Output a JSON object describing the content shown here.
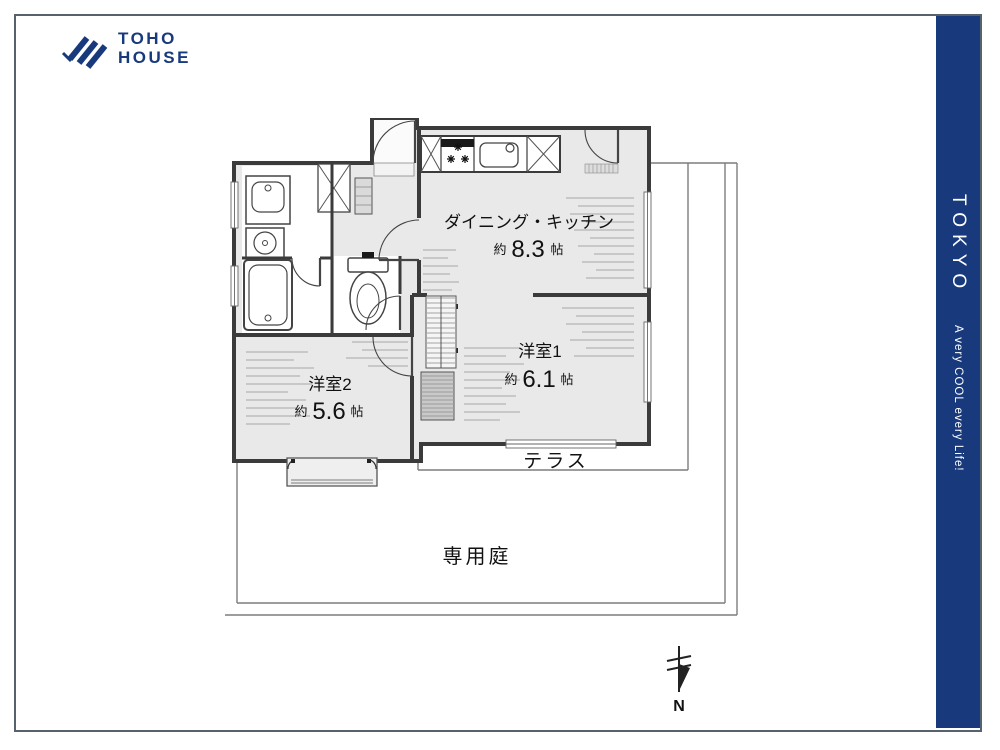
{
  "brand": {
    "line1": "TOHO",
    "line2": "HOUSE"
  },
  "banner": {
    "title": "TOKYO",
    "tagline": "A very COOL every Life!"
  },
  "plan": {
    "dk": {
      "name": "ダイニング・キッチン",
      "prefix": "約",
      "size": "8.3",
      "unit": "帖"
    },
    "room1": {
      "name": "洋室1",
      "prefix": "約",
      "size": "6.1",
      "unit": "帖"
    },
    "room2": {
      "name": "洋室2",
      "prefix": "約",
      "size": "5.6",
      "unit": "帖"
    },
    "terrace": "テラス",
    "garden": "専用庭",
    "north": "N"
  },
  "colors": {
    "navy": "#183a7d",
    "wall": "#3b3b3b",
    "room_fill": "#e9e9e9",
    "boundary": "#7d7d7d"
  }
}
